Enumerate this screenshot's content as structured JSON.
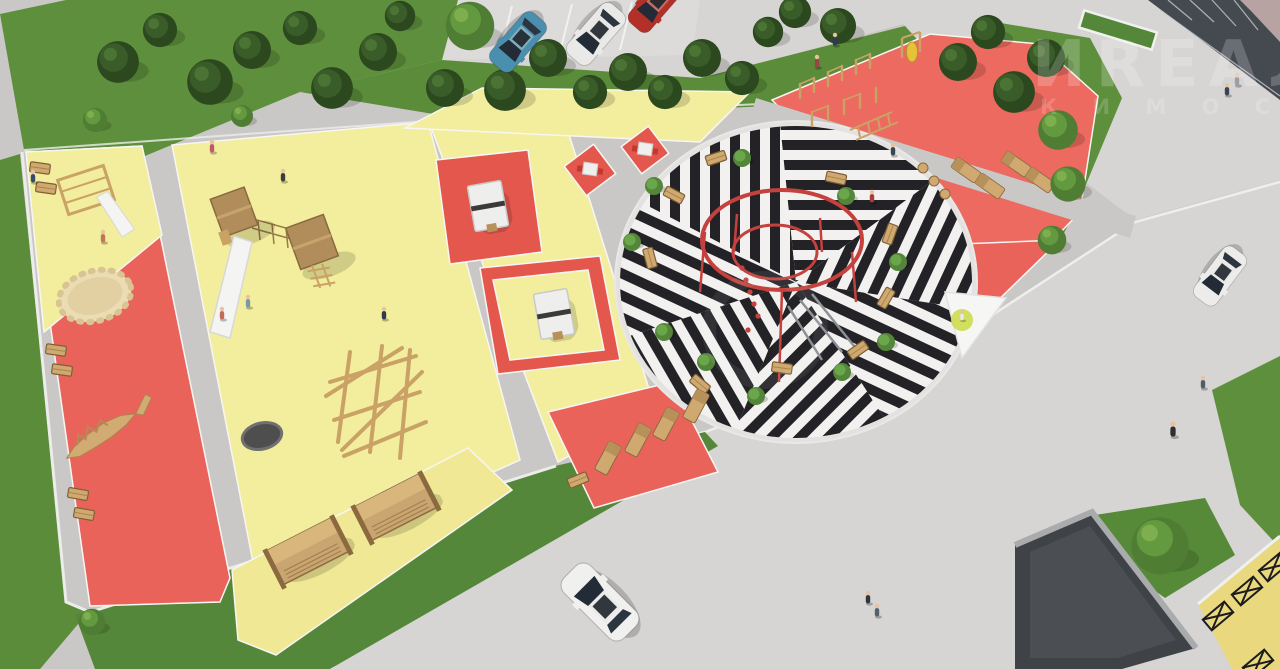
{
  "watermark": {
    "line1": "ИREAЛ",
    "line2": "К И М О С К",
    "color": "#ffffff"
  },
  "palette": {
    "pavement": "#c9c8c6",
    "road": "#d6d5d3",
    "parking": "#dcdbd9",
    "grass": "#5d8f3c",
    "tree_dark": "#2c481f",
    "zone_yellow": "#f2ee9d",
    "zone_red": "#ea635a",
    "sports_red": "#ec6a5f",
    "plaza_black": "#232327",
    "plaza_white": "#f2f1ef",
    "ring_red": "#c4413d",
    "wood": "#cfa96f",
    "slide_white": "#f4f4f2",
    "pavilion_roof": "#4b4e52",
    "walkway_yellow": "#ead87f",
    "glass": "#232c36"
  },
  "scene": {
    "view": "aerial-3d-render",
    "zones": [
      {
        "name": "toddler-red-strip",
        "surface": "red",
        "features": [
          "round sandbox",
          "crocodile balance beam",
          "3 bench pairs",
          "small climber with slide"
        ]
      },
      {
        "name": "kids-yellow-zone",
        "surface": "yellow",
        "features": [
          "twin play towers with roofs",
          "white slide",
          "rope bridge",
          "log climber",
          "manhole cover"
        ]
      },
      {
        "name": "games-strip",
        "surface": "yellow+red squares",
        "features": [
          "2 ping-pong tables",
          "2 chess tables with stools"
        ]
      },
      {
        "name": "lounger-red-pad",
        "surface": "red",
        "features": [
          "5 wooden sun loungers"
        ]
      },
      {
        "name": "swing-yellow-strip",
        "surface": "yellow",
        "features": [
          "2 covered swing pergolas"
        ]
      },
      {
        "name": "striped-plaza",
        "surface": "black-white striped sectors",
        "features": [
          "red double-ring climbing structure",
          "wooden benches",
          "small trees"
        ]
      },
      {
        "name": "workout-red-wedge",
        "surface": "red",
        "features": [
          "pull-up bar rows",
          "punching bag",
          "sit-up boards",
          "step stools",
          "white shade sail"
        ]
      }
    ],
    "vehicles": [
      {
        "type": "car",
        "color": "blue",
        "location": "top-parking"
      },
      {
        "type": "car",
        "color": "white",
        "location": "top-parking"
      },
      {
        "type": "car",
        "color": "red",
        "location": "top-parking-edge"
      },
      {
        "type": "car",
        "color": "white",
        "location": "right-road"
      },
      {
        "type": "car",
        "color": "white",
        "location": "bottom-road"
      }
    ],
    "buildings": [
      "glass-storefront-top-right",
      "dark-roof-pavilion-bottom-right"
    ],
    "people_count": 18
  }
}
